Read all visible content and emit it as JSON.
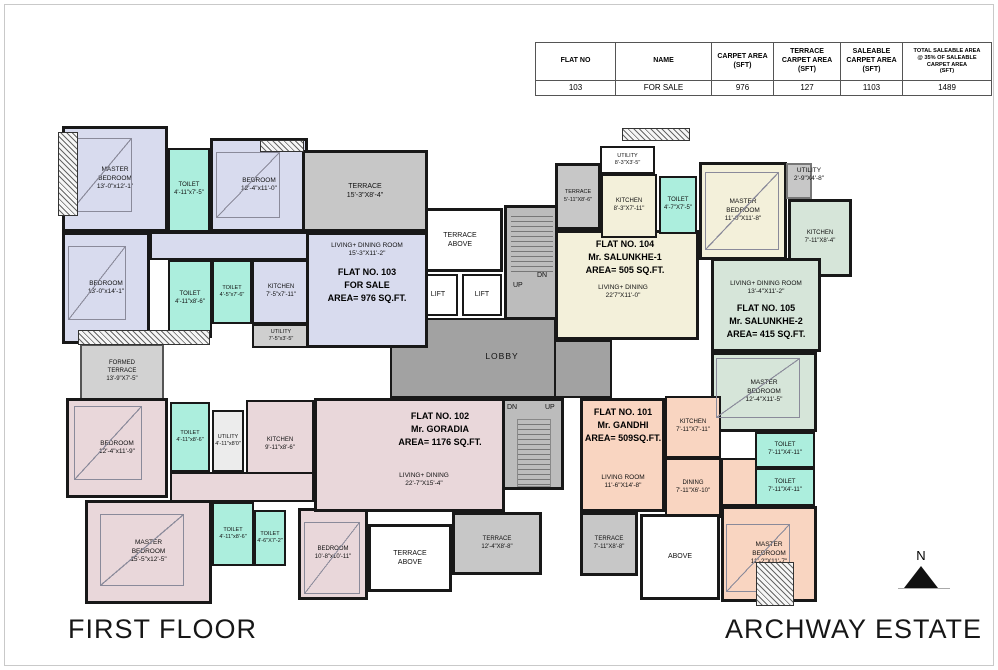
{
  "table": {
    "headers": [
      "FLAT NO",
      "NAME",
      "CARPET AREA\n(SFT)",
      "TERRACE\nCARPET AREA\n(SFT)",
      "SALEABLE\nCARPET AREA\n(SFT)",
      "TOTAL SALEABLE AREA\n@ 35% OF SALEABLE\nCARPET AREA\n(SFT)"
    ],
    "row": [
      "103",
      "FOR SALE",
      "976",
      "127",
      "1103",
      "1489"
    ]
  },
  "core": {
    "lobby": "LOBBY",
    "lift": "LIFT",
    "up": "UP",
    "dn": "DN",
    "terrace_above": "TERRACE\nABOVE",
    "above": "ABOVE"
  },
  "flat103": {
    "label": "FLAT NO. 103\nFOR SALE\nAREA= 976 SQ.FT.",
    "master": "MASTER\nBEDROOM\n13'-0\"x12'-1\"",
    "bedroom_left": "BEDROOM\n13'-0\"x14'-1\"",
    "bedroom_top": "BEDROOM\n12'-4\"x11'-0\"",
    "toilet_top": "TOILET\n4'-11\"x7'-5\"",
    "toilet_mid": "TOILET\n4'-11\"x8'-6\"",
    "toilet_small": "TOILET\n4'-5\"x7'-6\"",
    "kitchen": "KITCHEN\n7'-5\"x7'-11\"",
    "utility": "UTILITY\n7'-5\"x3'-5\"",
    "living": "LIVING+ DINING ROOM\n15'-3\"X11'-2\"",
    "terrace": "TERRACE\n15'-3\"X8'-4\""
  },
  "flat104": {
    "label": "FLAT NO. 104\nMr. SALUNKHE-1\nAREA= 505 SQ.FT.",
    "utility": "UTILITY\n8'-3\"X3'-5\"",
    "terrace": "TERRACE\n5'-11\"X8'-6\"",
    "kitchen": "KITCHEN\n8'-3\"X7'-11\"",
    "toilet": "TOILET\n4'-7\"X7'-5\"",
    "master": "MASTER\nBEDROOM\n11'-0\"X11'-8\"",
    "living": "LIVING+ DINING\n22'7\"X11'-0\""
  },
  "flat105": {
    "label": "FLAT NO. 105\nMr. SALUNKHE-2\nAREA= 415 SQ.FT.",
    "utility": "UTILITY\n2'-9\"X4'-8\"",
    "kitchen": "KITCHEN\n7'-11\"X8'-4\"",
    "living": "LIVING+ DINING ROOM\n13'-4\"X11'-2\"",
    "master": "MASTER\nBEDROOM\n12'-4\"X11'-5\"",
    "toilet_upper": "TOILET\n7'-11\"X4'-11\"",
    "toilet_lower": "TOILET\n7'-11\"X4'-11\""
  },
  "flat101": {
    "label": "FLAT NO. 101\nMr. GANDHI\nAREA= 509SQ.FT.",
    "kitchen": "KITCHEN\n7'-11\"X7'-11\"",
    "dining": "DINING\n7'-11\"X6'-10\"",
    "living": "LIVING ROOM\n11'-6\"X14'-8\"",
    "master": "MASTER\nBEDROOM\n11'-2\"X11'-7\"",
    "terrace": "TERRACE\n7'-11\"X8'-8\""
  },
  "flat102": {
    "label": "FLAT NO. 102\nMr. GORADIA\nAREA= 1176 SQ.FT.",
    "bedroom_top": "BEDROOM\n12'-4\"x11'-9\"",
    "toilet_top": "TOILET\n4'-11\"x8'-6\"",
    "utility": "UTILITY\n4'-11\"x8'0\"",
    "kitchen": "KITCHEN\n9'-11\"x8'-6\"",
    "master": "MASTER\nBEDROOM\n15'-5\"x12'-5\"",
    "toilet_mid": "TOILET\n4'-11\"x8'-6\"",
    "toilet_small": "TOILET\n4'-6\"X7'-2\"",
    "bedroom_bottom": "BEDROOM\n10'-8\"x10'-11\"",
    "living": "LIVING+ DINING\n22'-7\"X15'-4\"",
    "terrace": "TERRACE\n12'-4\"X8'-8\""
  },
  "terraces": {
    "formed": "FORMED\nTERRACE\n13'-9\"X7'-5\""
  },
  "footer": {
    "left": "FIRST FLOOR",
    "right": "ARCHWAY ESTATE"
  },
  "compass": {
    "n": "N"
  },
  "palette": {
    "flat103": "#d8dbee",
    "flat104": "#f3f0da",
    "flat105": "#d6e5d9",
    "flat102": "#e9d7da",
    "flat101": "#f9d5c1",
    "toilet": "#aceedd",
    "terrace": "#c7c7c7",
    "lobby": "#a2a2a2",
    "stair": "#bcbcbc",
    "wall": "#181818"
  }
}
